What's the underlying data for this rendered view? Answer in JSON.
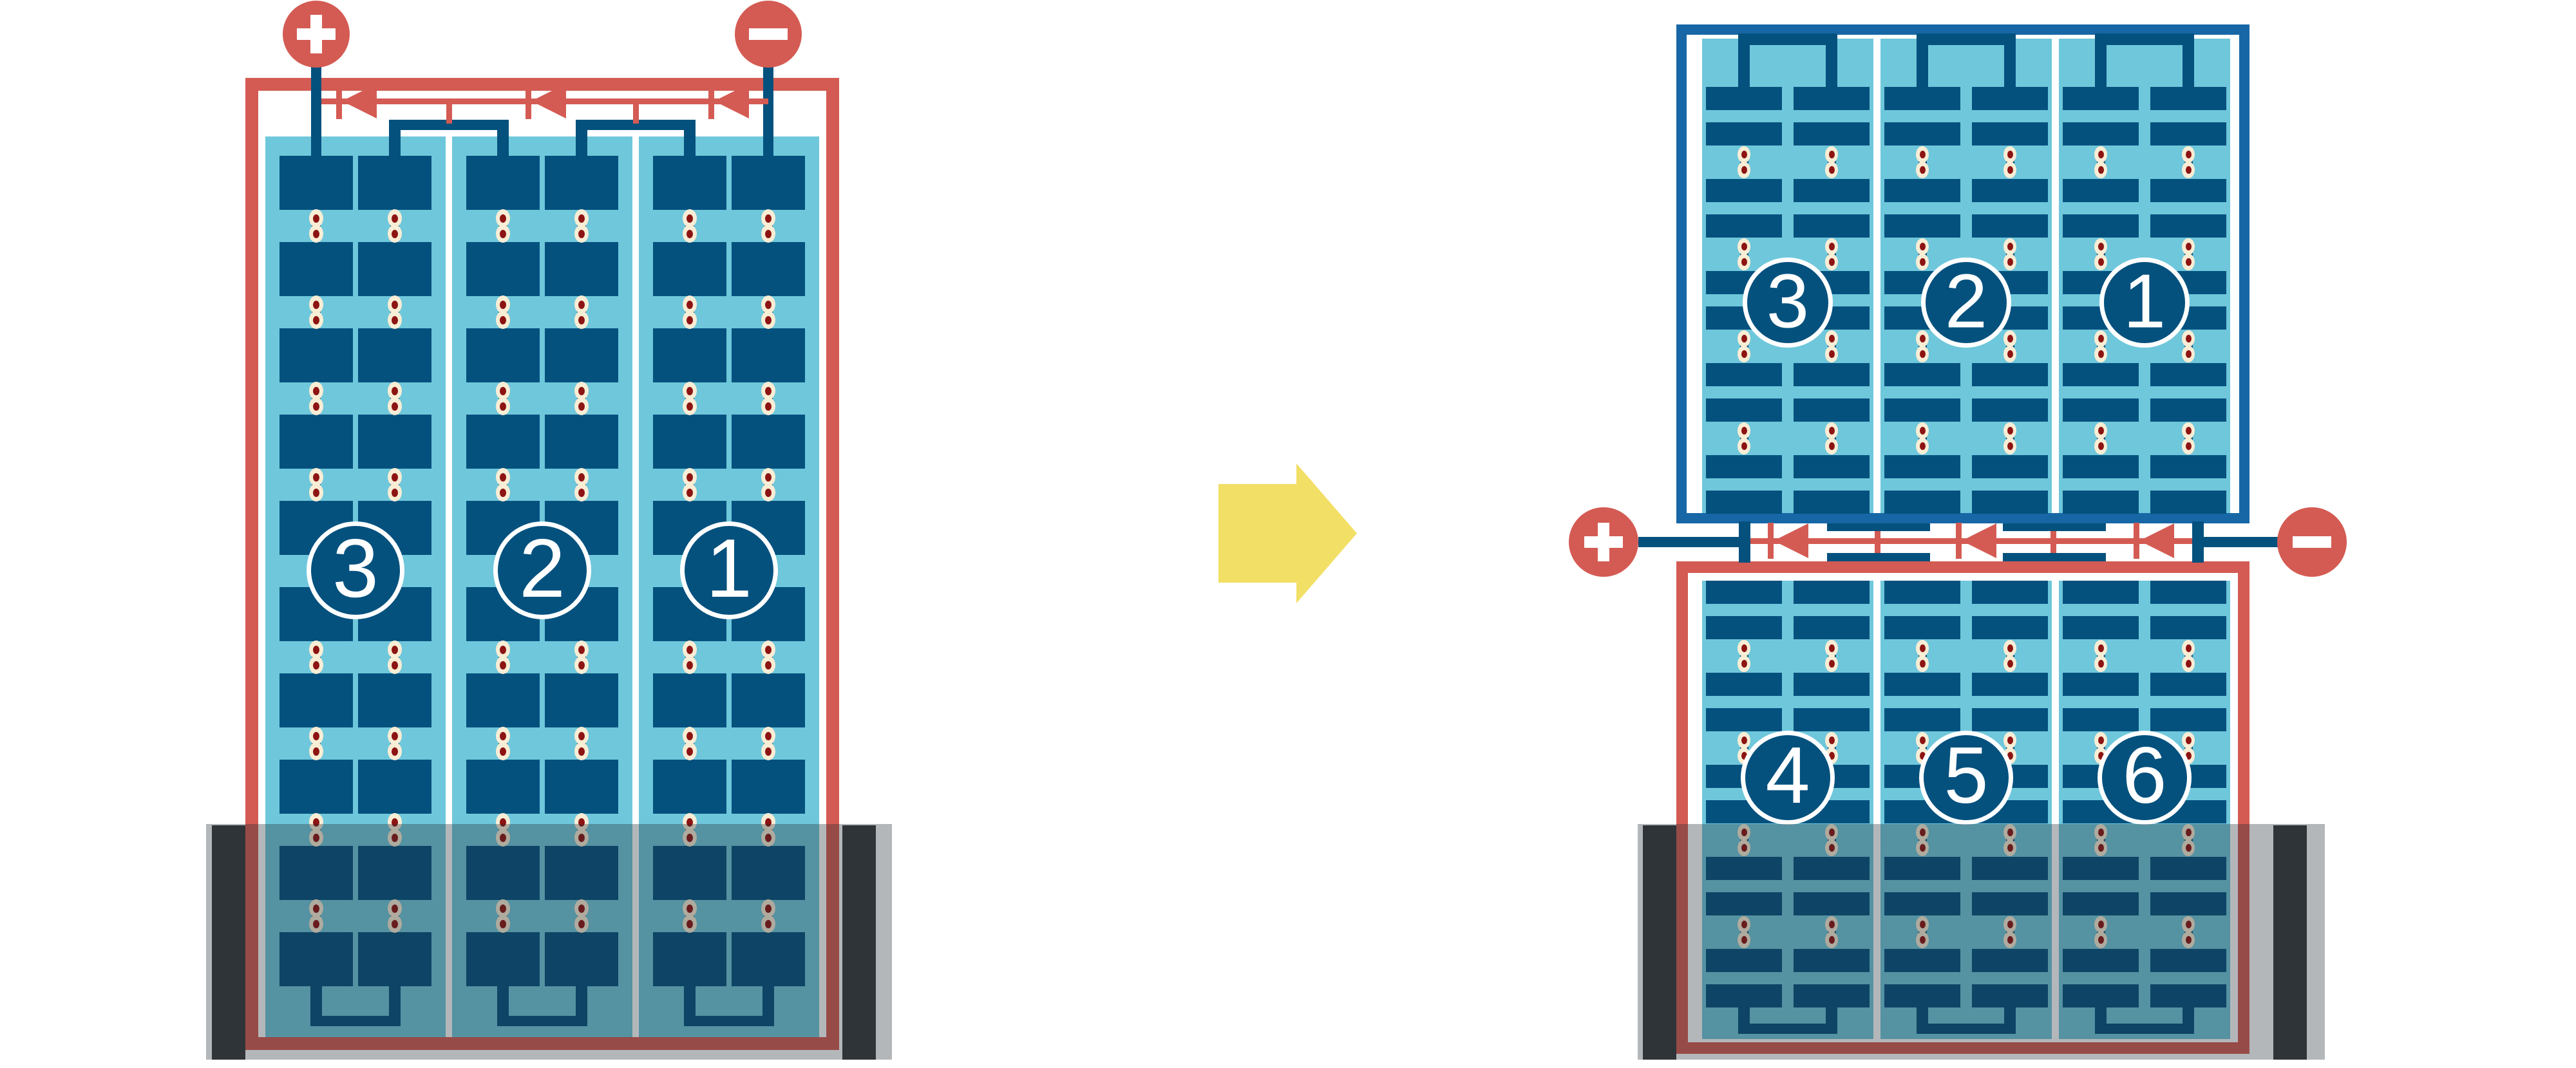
{
  "colors": {
    "accent_red": "#D45B53",
    "cell_navy": "#04517E",
    "frame_blue": "#1767A6",
    "panel_light_blue": "#6FC7DB",
    "solder_cream": "#F8EDD5",
    "solder_dot_red": "#8C1412",
    "arrow_yellow": "#F2DF65",
    "shade_overlay": "rgba(35,45,52,0.34)",
    "mount_bar_dark": "#36393B",
    "background": "#FFFFFF"
  },
  "left_module": {
    "positive_terminal_symbol": "+",
    "negative_terminal_symbol": "−",
    "substring_labels": [
      "3",
      "2",
      "1"
    ],
    "bypass_diode_count": 3
  },
  "right_module": {
    "positive_terminal_symbol": "+",
    "negative_terminal_symbol": "−",
    "top_substring_labels": [
      "3",
      "2",
      "1"
    ],
    "bottom_substring_labels": [
      "4",
      "5",
      "6"
    ],
    "bypass_diode_count": 3
  }
}
